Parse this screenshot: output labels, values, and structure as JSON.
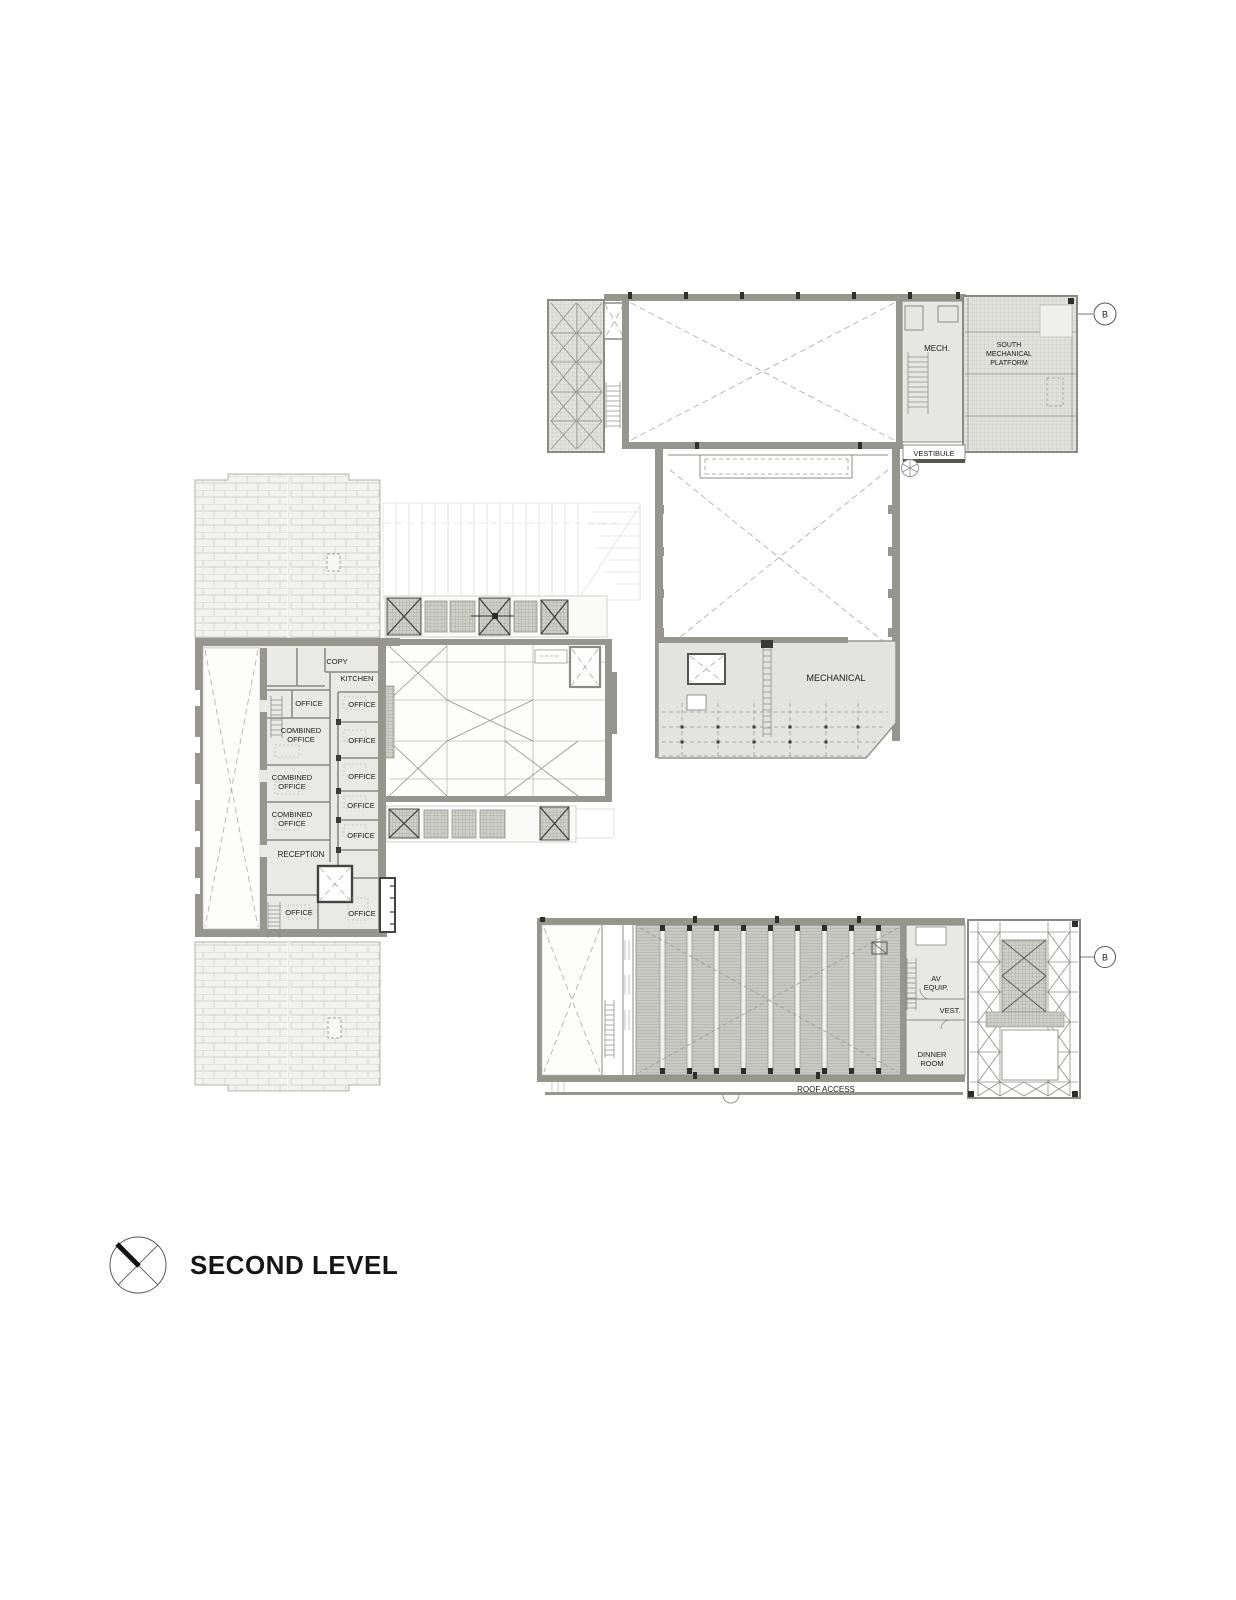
{
  "sheet": {
    "title": "SECOND LEVEL"
  },
  "section_markers": {
    "top": "B",
    "bottom": "B"
  },
  "north_building": {
    "mech": "MECH.",
    "south_mechanical_platform": [
      "SOUTH",
      "MECHANICAL",
      "PLATFORM"
    ],
    "vestibule": "VESTIBULE",
    "mechanical": "MECHANICAL"
  },
  "office_building": {
    "copy": "COPY",
    "kitchen": "KITCHEN",
    "office": "OFFICE",
    "combined_office": [
      "COMBINED",
      "OFFICE"
    ],
    "reception": "RECEPTION"
  },
  "south_building": {
    "av_equip": [
      "AV",
      "EQUIP."
    ],
    "vest": "VEST.",
    "dinner_room": [
      "DINNER",
      "ROOM"
    ],
    "roof_access": "ROOF ACCESS"
  }
}
